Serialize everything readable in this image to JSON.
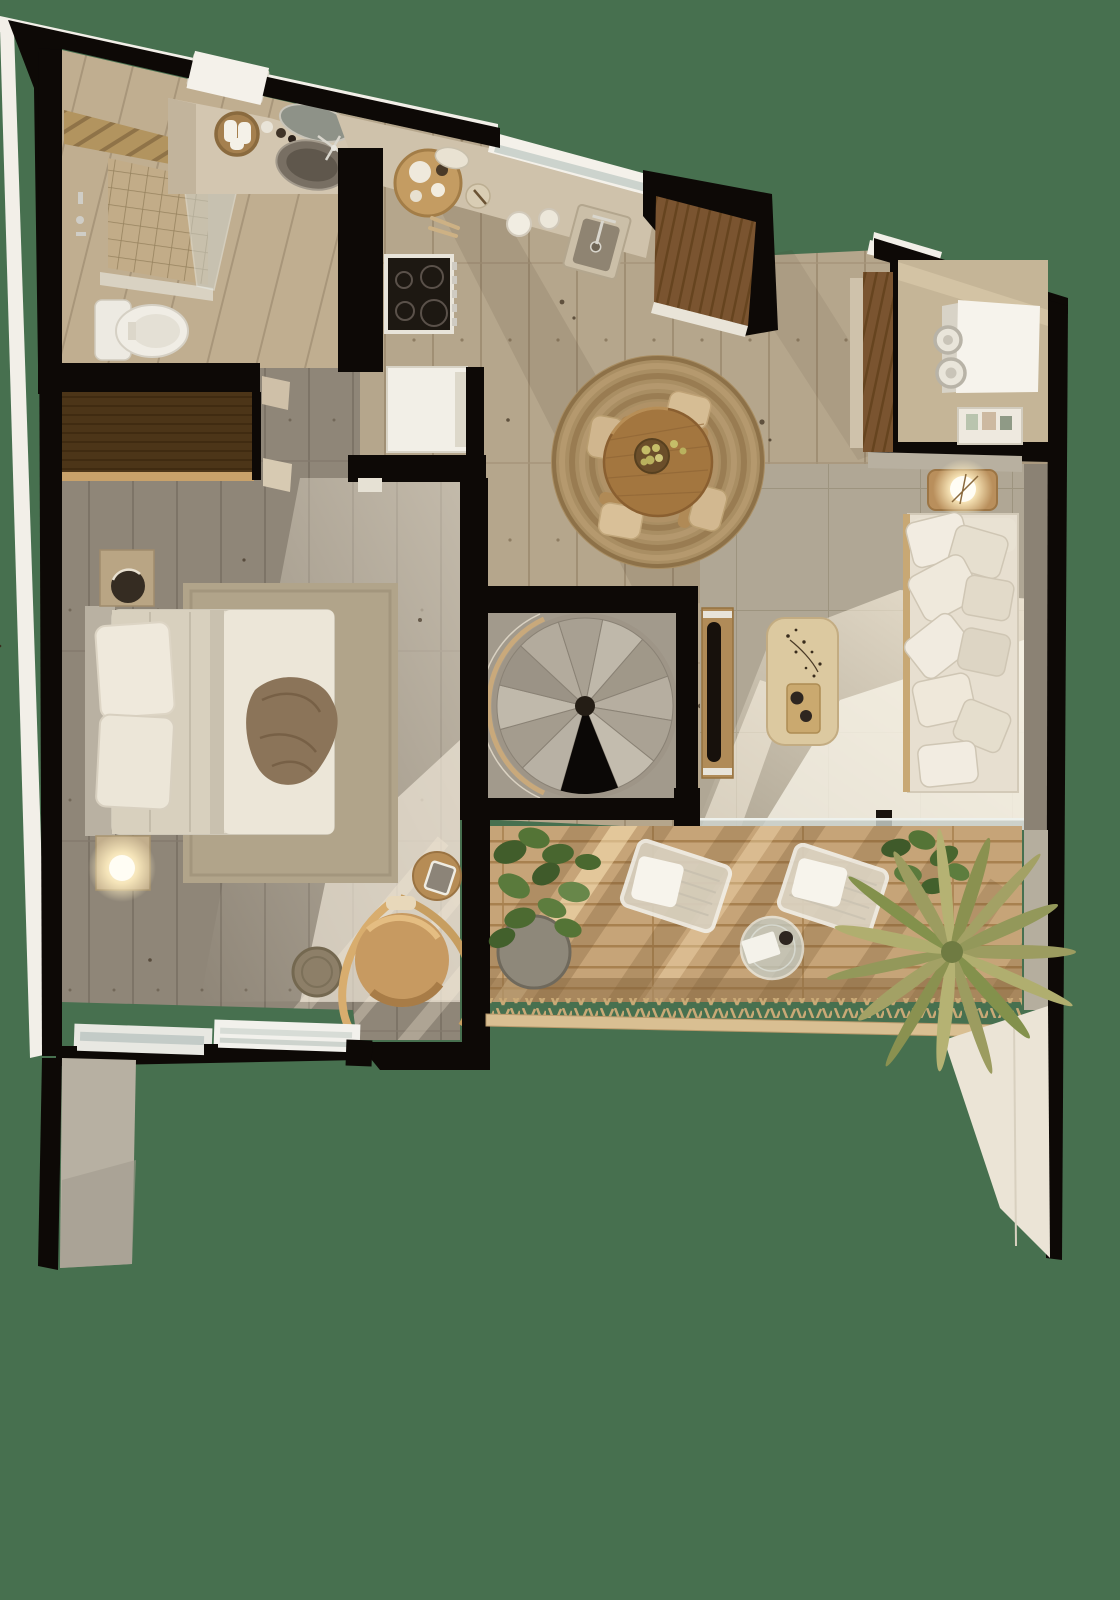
{
  "scene": {
    "title": "apartment-floor-plan-top-down-render",
    "view": "top-down 3D cutaway",
    "background_color": "#47704f",
    "palette": {
      "bg": "#47704f",
      "wall": "#0d0906",
      "edge": "#f2efe8",
      "floor-beige": "#b5a68c",
      "floor-gray": "#8f8678",
      "floor-living": "#b0a795",
      "floor-stair": "#a29a8c",
      "deck": "#c6a478",
      "counter": "#cfc2ab",
      "cream": "#e7dfd0",
      "white-fix": "#f0ede5",
      "walnut": "#7a5430",
      "wood-dark": "#5e421f",
      "wood-warm": "#a3763f",
      "wood-light": "#dcc9a0",
      "jute": "#a98e63",
      "glass": "#c7cdc7",
      "stone": "#786f63",
      "plant": "#4b6630",
      "palm": "#9c9c60",
      "tan": "#c79a61",
      "glow": "#fff3cf",
      "slab": "#ebe4d6",
      "slab-gray": "#b7b0a2",
      "sun": "#f6efdf"
    }
  },
  "rooms": {
    "bathroom": {
      "label": "Bathroom",
      "items": [
        "walk-in shower",
        "glass screen",
        "toilet",
        "vanity counter",
        "stone vessel sink",
        "mirror",
        "towel basket",
        "window shelf",
        "wood slat band"
      ]
    },
    "closet": {
      "label": "Wardrobe closet",
      "items": [
        "walnut wardrobe"
      ]
    },
    "kitchen": {
      "label": "Kitchen",
      "items": [
        "counter",
        "window strip",
        "sink with faucet",
        "induction cooktop",
        "white refrigerator",
        "walnut tall cabinet",
        "round serving tray",
        "plates",
        "mugs",
        "spoons"
      ]
    },
    "laundry": {
      "label": "Laundry closet",
      "items": [
        "washer-dryer stack",
        "decor shelf",
        "walnut side panel"
      ]
    },
    "dining": {
      "label": "Dining area",
      "items": [
        "round jute rug",
        "round wood table",
        "fruit bowl",
        "dining chair x4"
      ]
    },
    "stairs": {
      "label": "Spiral staircase",
      "items": [
        "concrete treads",
        "stair void",
        "curved handrail"
      ]
    },
    "bedroom": {
      "label": "Bedroom",
      "items": [
        "double bed",
        "pillows",
        "throw blanket",
        "area rug",
        "nightstand with lamp x2",
        "hanging chair",
        "round side table",
        "basket",
        "bottom windows"
      ]
    },
    "living": {
      "label": "Living room",
      "items": [
        "fabric sofa",
        "scatter cushions",
        "coffee table",
        "dried branch decor",
        "serving tray",
        "wall bench",
        "side table with lamp",
        "sliding glass door"
      ]
    },
    "balcony": {
      "label": "Balcony terrace",
      "items": [
        "wood deck",
        "lounger x2",
        "round glass table",
        "monstera plant",
        "palm plant",
        "rope railing"
      ]
    }
  }
}
